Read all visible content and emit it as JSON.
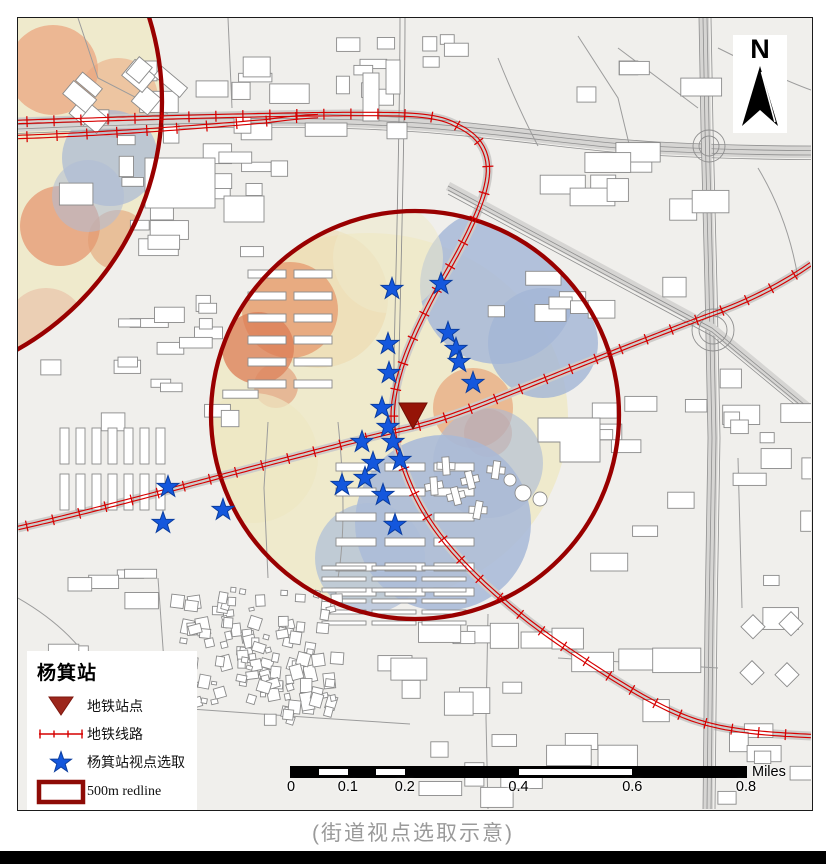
{
  "figure": {
    "caption": "(街道视点选取示意)"
  },
  "legend": {
    "title": "杨箕站",
    "items": [
      {
        "id": "station",
        "label": "地铁站点"
      },
      {
        "id": "metro-line",
        "label": "地铁线路"
      },
      {
        "id": "viewpoints",
        "label": "杨箕站视点选取"
      },
      {
        "id": "redline",
        "label": "500m redline"
      }
    ]
  },
  "north_arrow": {
    "label": "N"
  },
  "scale_bar": {
    "tick_labels": [
      "0",
      "0.1",
      "0.2",
      "0.4",
      "0.6",
      "0.8"
    ],
    "unit": "Miles"
  },
  "map": {
    "station": {
      "name": "杨箕站",
      "x": 395,
      "y": 396
    },
    "redline_circles": [
      {
        "cx": 397,
        "cy": 397,
        "r": 204
      },
      {
        "cx": -140,
        "cy": 84,
        "r": 284
      }
    ],
    "viewpoints": [
      [
        374,
        271
      ],
      [
        423,
        266
      ],
      [
        430,
        315
      ],
      [
        438,
        331
      ],
      [
        441,
        344
      ],
      [
        370,
        326
      ],
      [
        371,
        355
      ],
      [
        364,
        390
      ],
      [
        455,
        365
      ],
      [
        370,
        409
      ],
      [
        375,
        424
      ],
      [
        382,
        442
      ],
      [
        344,
        424
      ],
      [
        355,
        445
      ],
      [
        347,
        460
      ],
      [
        324,
        467
      ],
      [
        365,
        477
      ],
      [
        377,
        507
      ],
      [
        150,
        469
      ],
      [
        145,
        505
      ],
      [
        205,
        492
      ]
    ]
  },
  "colors": {
    "redline": "#990000",
    "metro": "#d60000",
    "station": "#951407",
    "viewpoint": "#1457dd"
  }
}
